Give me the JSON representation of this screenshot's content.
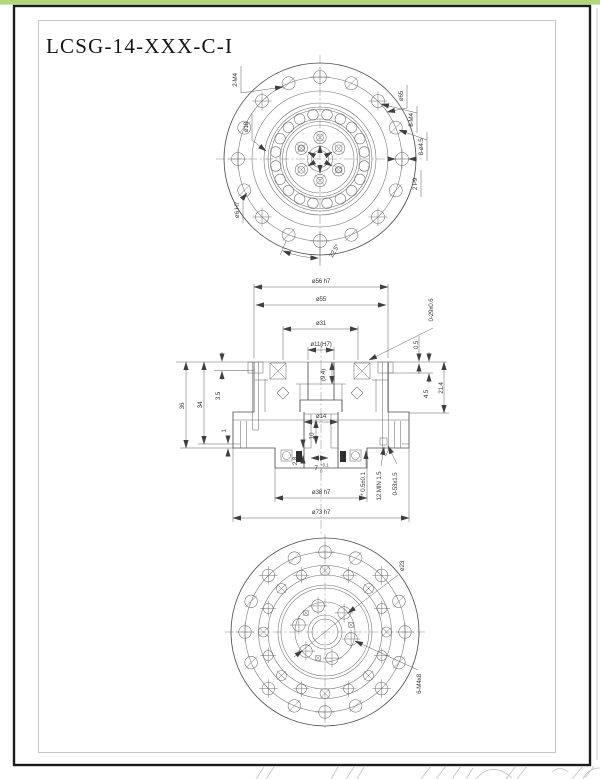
{
  "sheet": {
    "title": "LCSG-14-XXX-C-I"
  },
  "top_view": {
    "label_2m4": "2-M4",
    "label_d18": "ø18",
    "label_d65": "ø65",
    "label_8m4": "8-M4",
    "label_8d45": "8-ø4.5",
    "label_2p9": "2 P9",
    "label_d6h7": "ø6 H7",
    "label_angle": "22.5°"
  },
  "section_view": {
    "d56": "ø56 h7",
    "d55": "ø55",
    "d31": "ø31",
    "d11": "ø11(H7)",
    "oring_top": "0-29x0.6",
    "t05": "0.5",
    "t214": "21.4",
    "t45": "4.5",
    "t94": "(9.4)",
    "h36": "36",
    "h34": "34",
    "h35": "3.5",
    "h1": "1",
    "d14": "ø14",
    "t10": "10",
    "t28": "2.8",
    "t7": "7",
    "t7_tol_up": "+0.1",
    "t7_tol_dn": "0",
    "gap": "* 0.5±0.1",
    "depth": "12:MIN 1.5",
    "oring_bot": "0-53x1.5",
    "d38": "ø38 h7",
    "d73": "ø73 h7"
  },
  "bottom_view": {
    "d23": "ø23",
    "m4x8": "6-M4x8"
  },
  "colors": {
    "accent_strip": "#b1d57c",
    "sheet_border": "#1c1c1c",
    "line": "#555555"
  }
}
